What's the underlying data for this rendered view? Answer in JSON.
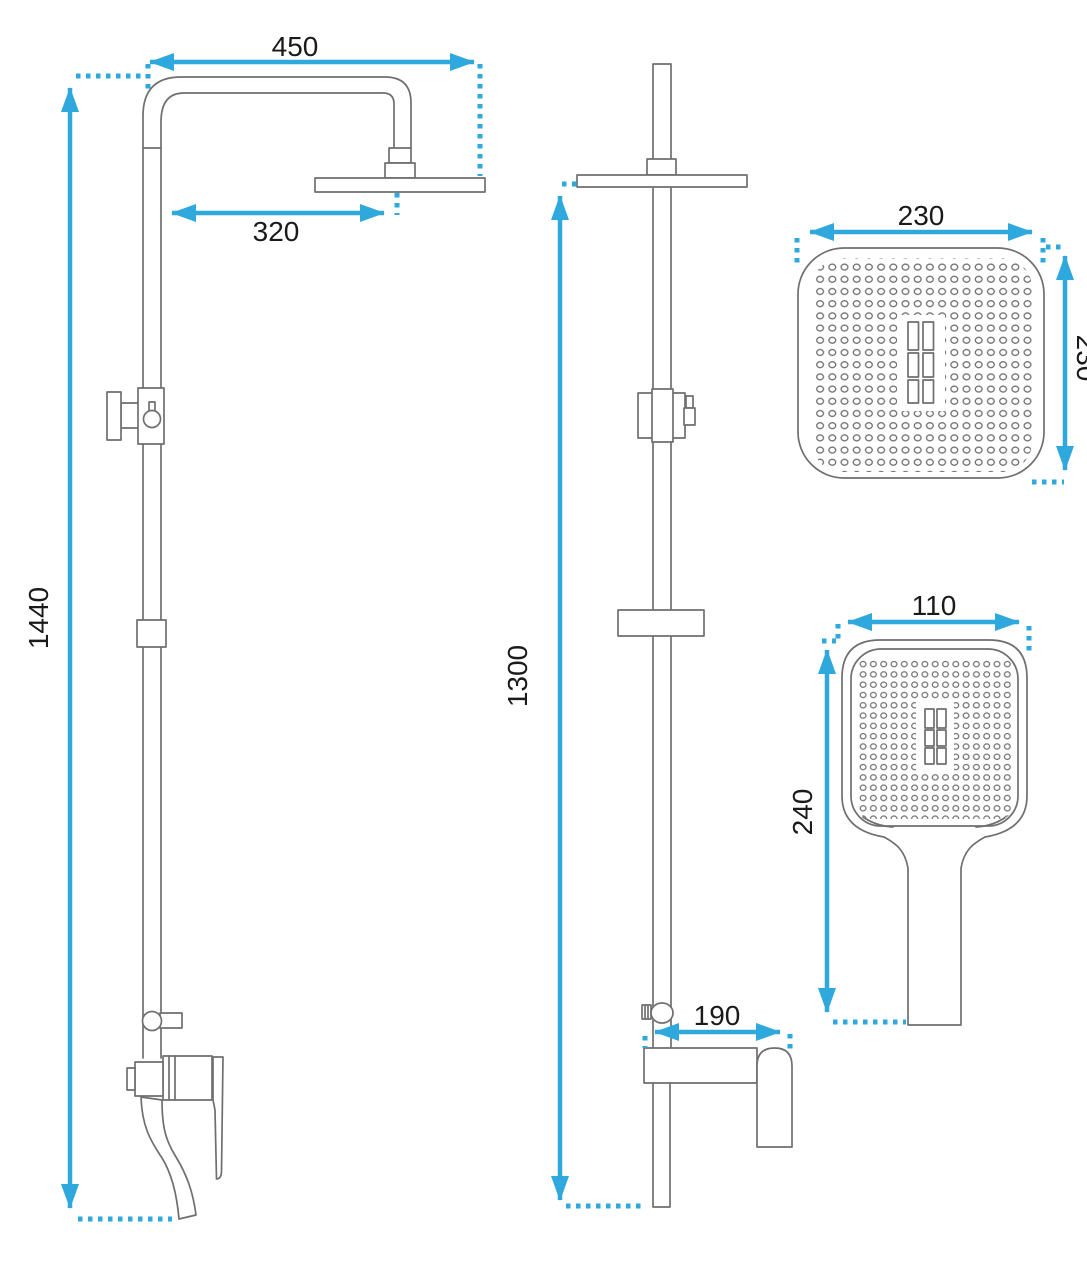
{
  "drawing": {
    "type": "technical-dimension-drawing",
    "subject": "shower-column-set",
    "colors": {
      "background": "#ffffff",
      "outline": "#6f6f6f",
      "dimension": "#2ea8dd",
      "text": "#1a1a1a"
    },
    "views": {
      "front": {
        "labels": {
          "arm_reach": "450",
          "head_offset": "320",
          "total_height": "1440"
        }
      },
      "side": {
        "labels": {
          "column_height": "1300",
          "spout_reach": "190"
        }
      },
      "overhead_head_face": {
        "labels": {
          "width": "230",
          "depth": "230"
        }
      },
      "hand_shower": {
        "labels": {
          "width": "110",
          "length": "240"
        }
      }
    }
  }
}
